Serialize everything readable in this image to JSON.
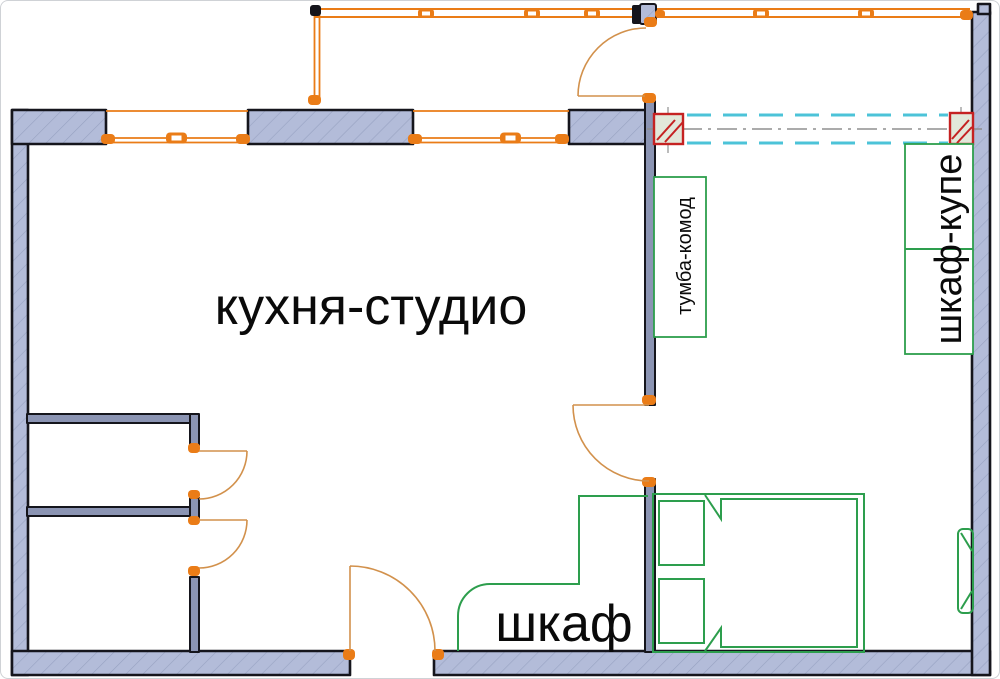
{
  "plan": {
    "rooms": {
      "kitchen_studio_label": "кухня-студио"
    },
    "furniture": {
      "wardrobe_label": "шкаф",
      "sliding_wardrobe_label": "шкаф-купе",
      "dresser_label": "тумба-комод"
    },
    "colors": {
      "wall-fill": "#b3bcd9",
      "outline": "#15151c",
      "inner-wall": "#8b94b3",
      "orange": "#ea7c17",
      "door": "#d2914c",
      "green": "#2d9e4d",
      "red": "#c52222",
      "cyan": "#4cc3d8",
      "gray": "#8f8f8f",
      "column-fill": "#e2e8da",
      "text": "#0a0a0a"
    }
  }
}
